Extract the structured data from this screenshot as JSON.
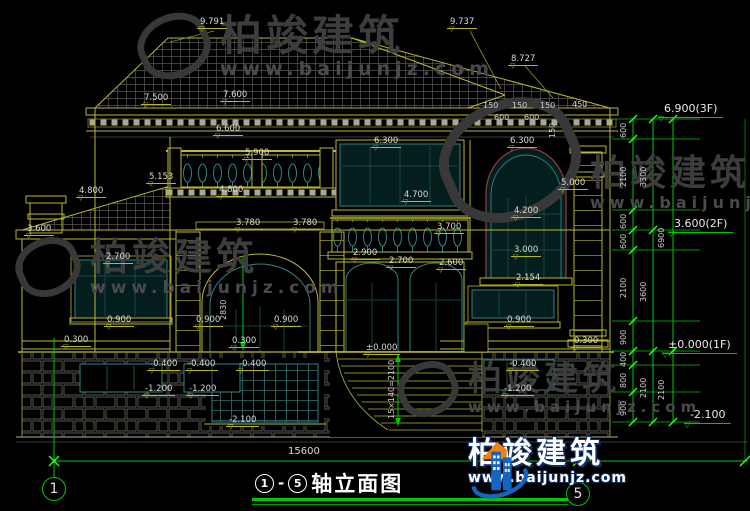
{
  "app": {
    "type": "architectural-elevation-cad-drawing",
    "background": "#000000"
  },
  "brand": {
    "name": "柏竣建筑",
    "url": "www.baijunjz.com"
  },
  "title_block": {
    "axis_start": "1",
    "dash": "-",
    "axis_end": "5",
    "title": "轴立面图"
  },
  "axis_bubbles": {
    "left": "1",
    "right": "5"
  },
  "overall_dimension": "15600",
  "watermarks": [
    {
      "text": "柏竣建筑",
      "url": "www.baijunjz.com"
    },
    {
      "text": "柏竣建筑",
      "url": "www.baijunjz.com"
    },
    {
      "text": "柏竣建筑",
      "url": "www.baijunjz.com"
    },
    {
      "text": "柏竣建筑",
      "url": "www.baijunjz.com"
    }
  ],
  "annotations": {
    "elevations": [
      {
        "t": "9.791",
        "x": 197,
        "y": 18
      },
      {
        "t": "9.737",
        "x": 447,
        "y": 18
      },
      {
        "t": "8.727",
        "x": 508,
        "y": 55
      },
      {
        "t": "7.500",
        "x": 141,
        "y": 94
      },
      {
        "t": "7.600",
        "x": 220,
        "y": 91
      },
      {
        "t": "6.600",
        "x": 213,
        "y": 125
      },
      {
        "t": "5.900",
        "x": 242,
        "y": 149
      },
      {
        "t": "5.153",
        "x": 146,
        "y": 173
      },
      {
        "t": "4.800",
        "x": 76,
        "y": 187
      },
      {
        "t": "4.800",
        "x": 216,
        "y": 186
      },
      {
        "t": "3.780",
        "x": 233,
        "y": 219
      },
      {
        "t": "3.780",
        "x": 290,
        "y": 219
      },
      {
        "t": "6.300",
        "x": 371,
        "y": 137
      },
      {
        "t": "6.300",
        "x": 507,
        "y": 137
      },
      {
        "t": "4.700",
        "x": 401,
        "y": 191
      },
      {
        "t": "3.700",
        "x": 434,
        "y": 223
      },
      {
        "t": "4.200",
        "x": 511,
        "y": 207
      },
      {
        "t": "3.000",
        "x": 511,
        "y": 246
      },
      {
        "t": "2.154",
        "x": 513,
        "y": 274
      },
      {
        "t": "2.900",
        "x": 350,
        "y": 249
      },
      {
        "t": "2.700",
        "x": 386,
        "y": 257
      },
      {
        "t": "2.600",
        "x": 436,
        "y": 259
      },
      {
        "t": "3.600",
        "x": 24,
        "y": 225
      },
      {
        "t": "2.700",
        "x": 103,
        "y": 253
      },
      {
        "t": "5.000",
        "x": 558,
        "y": 179
      },
      {
        "t": "0.900",
        "x": 104,
        "y": 316
      },
      {
        "t": "0.900",
        "x": 193,
        "y": 316
      },
      {
        "t": "0.900",
        "x": 271,
        "y": 316
      },
      {
        "t": "0.900",
        "x": 504,
        "y": 316
      },
      {
        "t": "0.300",
        "x": 61,
        "y": 336
      },
      {
        "t": "0.300",
        "x": 229,
        "y": 337
      },
      {
        "t": "0.300",
        "x": 571,
        "y": 337
      },
      {
        "t": "-0.400",
        "x": 147,
        "y": 360
      },
      {
        "t": "-0.400",
        "x": 185,
        "y": 360
      },
      {
        "t": "-0.400",
        "x": 236,
        "y": 360
      },
      {
        "t": "-0.400",
        "x": 506,
        "y": 360
      },
      {
        "t": "-1.200",
        "x": 142,
        "y": 385
      },
      {
        "t": "-1.200",
        "x": 186,
        "y": 385
      },
      {
        "t": "-1.200",
        "x": 501,
        "y": 385
      },
      {
        "t": "-2.100",
        "x": 226,
        "y": 416
      },
      {
        "t": "±0.000",
        "x": 363,
        "y": 344
      }
    ],
    "right_levels": [
      {
        "t": "6.900(3F)",
        "x": 658,
        "y": 103
      },
      {
        "t": "3.600(2F)",
        "x": 668,
        "y": 218
      },
      {
        "t": "±0.000(1F)",
        "x": 662,
        "y": 339
      },
      {
        "t": "-2.100",
        "x": 684,
        "y": 409
      }
    ],
    "small_dims": [
      {
        "t": "150",
        "x": 483,
        "y": 102
      },
      {
        "t": "150",
        "x": 512,
        "y": 102
      },
      {
        "t": "150",
        "x": 540,
        "y": 102
      },
      {
        "t": "450",
        "x": 572,
        "y": 101
      },
      {
        "t": "600",
        "x": 494,
        "y": 114
      },
      {
        "t": "600",
        "x": 524,
        "y": 114
      }
    ],
    "rotated_dims": [
      {
        "t": "2830",
        "x": 220,
        "y": 320
      },
      {
        "t": "15×140=2100",
        "x": 388,
        "y": 419
      },
      {
        "t": "150",
        "x": 549,
        "y": 138
      },
      {
        "t": "600",
        "x": 620,
        "y": 138
      },
      {
        "t": "2100",
        "x": 620,
        "y": 187
      },
      {
        "t": "600",
        "x": 620,
        "y": 229
      },
      {
        "t": "600",
        "x": 620,
        "y": 249
      },
      {
        "t": "2100",
        "x": 620,
        "y": 298
      },
      {
        "t": "900",
        "x": 620,
        "y": 345
      },
      {
        "t": "400",
        "x": 620,
        "y": 367
      },
      {
        "t": "800",
        "x": 620,
        "y": 388
      },
      {
        "t": "900",
        "x": 620,
        "y": 416
      },
      {
        "t": "3300",
        "x": 640,
        "y": 187
      },
      {
        "t": "3600",
        "x": 640,
        "y": 302
      },
      {
        "t": "2100",
        "x": 640,
        "y": 398
      },
      {
        "t": "6900",
        "x": 658,
        "y": 248
      },
      {
        "t": "2100",
        "x": 658,
        "y": 400
      }
    ]
  },
  "dim_system": {
    "levels_y": [
      119,
      139,
      210,
      230,
      250,
      321,
      351,
      365,
      392,
      422
    ],
    "chains": [
      {
        "x": 633,
        "levels": [
          119,
          139,
          210,
          230,
          250,
          321,
          351,
          365,
          392,
          422
        ]
      },
      {
        "x": 653,
        "levels": [
          119,
          230,
          351,
          422
        ]
      },
      {
        "x": 673,
        "levels": [
          119,
          351,
          422
        ]
      }
    ]
  },
  "colors": {
    "line_olive": "#b9b92e",
    "dim_green": "#00c800",
    "tick_green": "#2aff2a",
    "text": "#d9d9d9",
    "window_teal": "#2f8585",
    "arch_frame_red": "#8a3a3a",
    "logo_blue": "#1565c0",
    "logo_orange": "#f08010"
  }
}
